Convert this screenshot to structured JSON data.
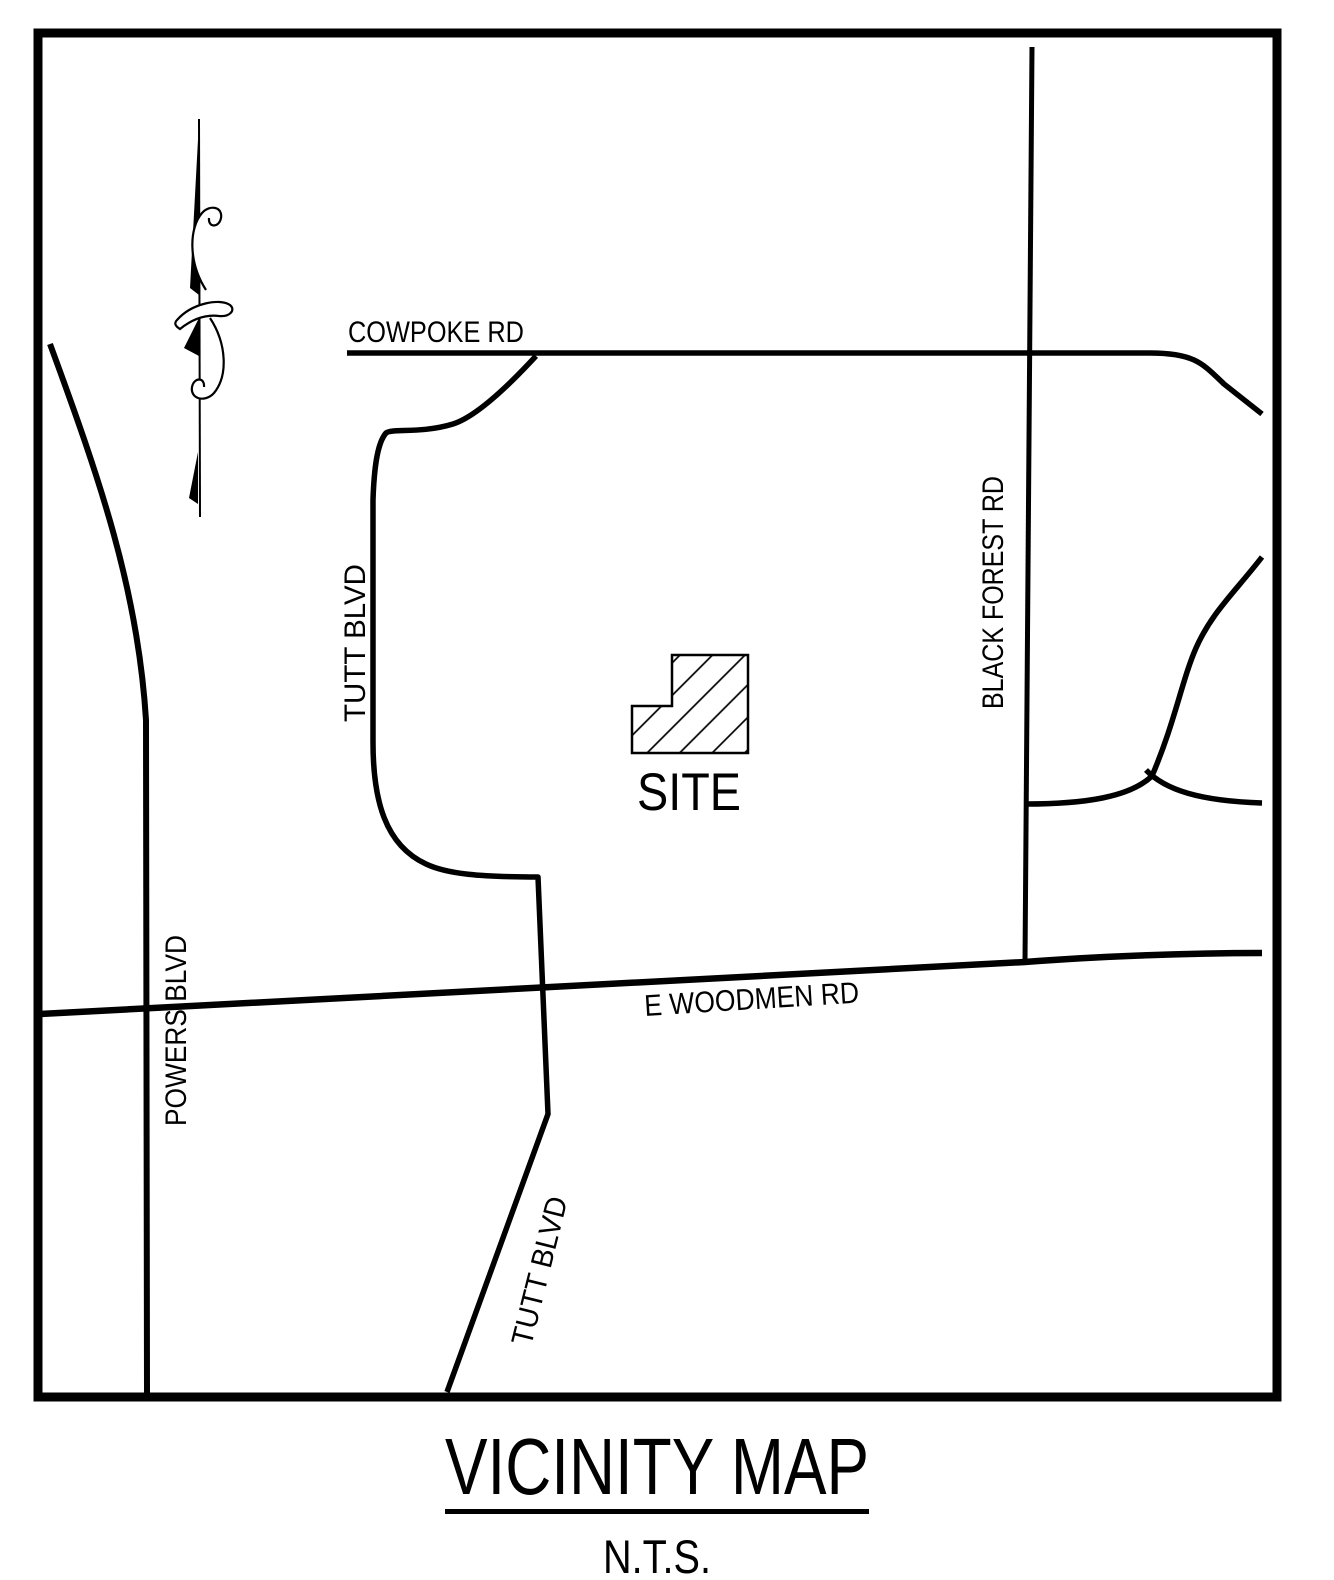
{
  "drawing": {
    "title": "VICINITY MAP",
    "scale_note": "N.T.S.",
    "site_label": "SITE",
    "roads": {
      "cowpoke": "COWPOKE RD",
      "tutt_upper": "TUTT BLVD",
      "black_forest": "BLACK FOREST RD",
      "powers": "POWERS BLVD",
      "woodmen": "E WOODMEN RD",
      "tutt_lower": "TUTT BLVD"
    },
    "icons": {
      "north_arrow": "ornate-north-arrow"
    },
    "colors": {
      "ink": "#000000",
      "paper": "#ffffff"
    }
  }
}
